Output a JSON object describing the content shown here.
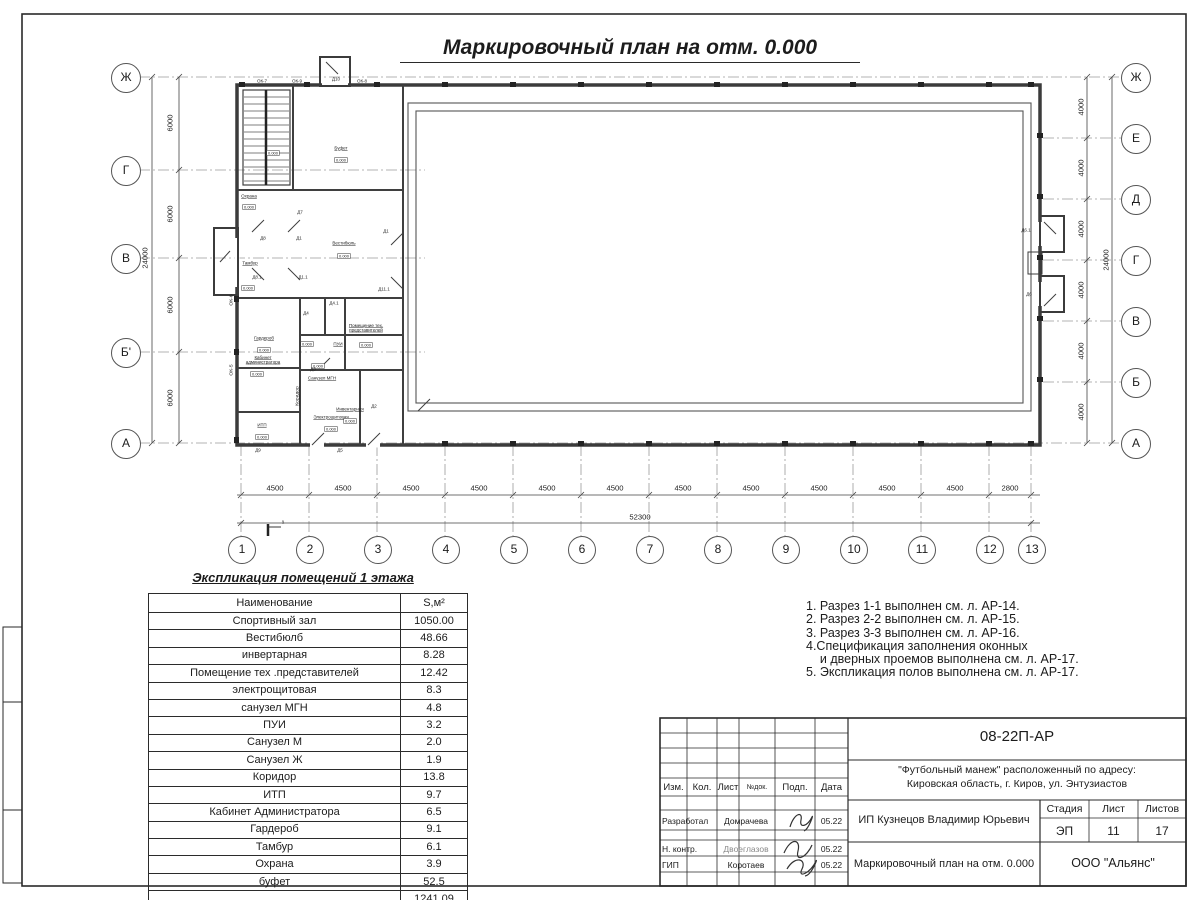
{
  "sheet": {
    "title": "Маркировочный план на отм. 0.000"
  },
  "plan": {
    "axes_left": [
      {
        "label": "Ж",
        "y": 77
      },
      {
        "label": "Г",
        "y": 170
      },
      {
        "label": "В",
        "y": 258
      },
      {
        "label": "Б'",
        "y": 352
      },
      {
        "label": "А",
        "y": 443
      }
    ],
    "axes_right": [
      {
        "label": "Ж",
        "y": 77
      },
      {
        "label": "Е",
        "y": 138
      },
      {
        "label": "Д",
        "y": 199
      },
      {
        "label": "Г",
        "y": 260
      },
      {
        "label": "В",
        "y": 321
      },
      {
        "label": "Б",
        "y": 382
      },
      {
        "label": "А",
        "y": 443
      }
    ],
    "columns": [
      {
        "label": "1",
        "x": 241
      },
      {
        "label": "2",
        "x": 309
      },
      {
        "label": "3",
        "x": 377
      },
      {
        "label": "4",
        "x": 445
      },
      {
        "label": "5",
        "x": 513
      },
      {
        "label": "6",
        "x": 581
      },
      {
        "label": "7",
        "x": 649
      },
      {
        "label": "8",
        "x": 717
      },
      {
        "label": "9",
        "x": 785
      },
      {
        "label": "10",
        "x": 853
      },
      {
        "label": "11",
        "x": 921
      },
      {
        "label": "12",
        "x": 989
      },
      {
        "label": "13",
        "x": 1031
      }
    ],
    "dims_bottom": [
      {
        "v": "4500",
        "x": 275
      },
      {
        "v": "4500",
        "x": 343
      },
      {
        "v": "4500",
        "x": 411
      },
      {
        "v": "4500",
        "x": 479
      },
      {
        "v": "4500",
        "x": 547
      },
      {
        "v": "4500",
        "x": 615
      },
      {
        "v": "4500",
        "x": 683
      },
      {
        "v": "4500",
        "x": 751
      },
      {
        "v": "4500",
        "x": 819
      },
      {
        "v": "4500",
        "x": 887
      },
      {
        "v": "4500",
        "x": 955
      },
      {
        "v": "2800",
        "x": 1010
      }
    ],
    "dims_left": [
      {
        "v": "6000",
        "y": 123
      },
      {
        "v": "6000",
        "y": 214
      },
      {
        "v": "6000",
        "y": 305
      },
      {
        "v": "6000",
        "y": 398
      }
    ],
    "dims_right": [
      {
        "v": "4000",
        "y": 107
      },
      {
        "v": "4000",
        "y": 168
      },
      {
        "v": "4000",
        "y": 229
      },
      {
        "v": "4000",
        "y": 290
      },
      {
        "v": "4000",
        "y": 351
      },
      {
        "v": "4000",
        "y": 412
      }
    ],
    "dim_total_bottom": "52300",
    "dim_total_left": "24000",
    "dim_total_right": "24000",
    "section_label": "1",
    "level_text": "0.000",
    "rooms": [
      {
        "t": "Охрана",
        "x": 249,
        "y": 196
      },
      {
        "t": "Буфет",
        "x": 341,
        "y": 148
      },
      {
        "t": "Вестибюль",
        "x": 344,
        "y": 243
      },
      {
        "t": "Тамбур",
        "x": 250,
        "y": 263
      },
      {
        "t": "Гардероб",
        "x": 264,
        "y": 338
      },
      {
        "t": "Кабинет администратора",
        "x": 263,
        "y": 360,
        "wrap": true
      },
      {
        "t": "ИТП",
        "x": 262,
        "y": 425
      },
      {
        "t": "ПУИ",
        "x": 338,
        "y": 344
      },
      {
        "t": "Санузел МГН",
        "x": 322,
        "y": 378
      },
      {
        "t": "Коридор",
        "x": 297,
        "y": 396,
        "rot": true
      },
      {
        "t": "Электрощитовая",
        "x": 331,
        "y": 417
      },
      {
        "t": "Инвентарная",
        "x": 350,
        "y": 409
      },
      {
        "t": "Помещение тех. представителей",
        "x": 366,
        "y": 328,
        "wrap": true
      }
    ],
    "levels": [
      {
        "x": 273,
        "y": 153
      },
      {
        "x": 341,
        "y": 160
      },
      {
        "x": 344,
        "y": 256
      },
      {
        "x": 248,
        "y": 288
      },
      {
        "x": 264,
        "y": 350
      },
      {
        "x": 257,
        "y": 374
      },
      {
        "x": 262,
        "y": 437
      },
      {
        "x": 307,
        "y": 344
      },
      {
        "x": 318,
        "y": 366
      },
      {
        "x": 331,
        "y": 429
      },
      {
        "x": 350,
        "y": 421
      },
      {
        "x": 366,
        "y": 345
      },
      {
        "x": 249,
        "y": 207
      }
    ],
    "marks": [
      {
        "t": "ОК-7",
        "x": 262,
        "y": 81
      },
      {
        "t": "ОК-9",
        "x": 297,
        "y": 81
      },
      {
        "t": "Д10",
        "x": 336,
        "y": 79
      },
      {
        "t": "ОК-8",
        "x": 362,
        "y": 81
      },
      {
        "t": "Д8",
        "x": 263,
        "y": 238
      },
      {
        "t": "Д1",
        "x": 299,
        "y": 238
      },
      {
        "t": "Д8.1",
        "x": 257,
        "y": 277
      },
      {
        "t": "Д1.1",
        "x": 303,
        "y": 277
      },
      {
        "t": "Д7",
        "x": 300,
        "y": 212
      },
      {
        "t": "Д1",
        "x": 386,
        "y": 231
      },
      {
        "t": "Д11.1",
        "x": 384,
        "y": 289
      },
      {
        "t": "Д4",
        "x": 306,
        "y": 313
      },
      {
        "t": "Д4.1",
        "x": 334,
        "y": 303
      },
      {
        "t": "Д3",
        "x": 313,
        "y": 369
      },
      {
        "t": "Д2",
        "x": 374,
        "y": 406
      },
      {
        "t": "Д6.1",
        "x": 1026,
        "y": 230
      },
      {
        "t": "Д6",
        "x": 1029,
        "y": 294
      },
      {
        "t": "ОК-6",
        "x": 231,
        "y": 300,
        "rot": true
      },
      {
        "t": "ОК-5",
        "x": 231,
        "y": 370,
        "rot": true
      },
      {
        "t": "Д9",
        "x": 258,
        "y": 450
      },
      {
        "t": "Д5",
        "x": 340,
        "y": 450
      }
    ]
  },
  "explication": {
    "title": "Экспликация помещений 1 этажа",
    "col_name": "Наименование",
    "col_area": "S,м²",
    "rows": [
      [
        "Спортивный зал",
        "1050.00"
      ],
      [
        "Вестибюлб",
        "48.66"
      ],
      [
        "инвертарная",
        "8.28"
      ],
      [
        "Помещение тех .представителей",
        "12.42"
      ],
      [
        "электрощитовая",
        "8.3"
      ],
      [
        "санузел МГН",
        "4.8"
      ],
      [
        "ПУИ",
        "3.2"
      ],
      [
        "Санузел М",
        "2.0"
      ],
      [
        "Санузел Ж",
        "1.9"
      ],
      [
        "Коридор",
        "13.8"
      ],
      [
        "ИТП",
        "9.7"
      ],
      [
        "Кабинет Администратора",
        "6.5"
      ],
      [
        "Гардероб",
        "9.1"
      ],
      [
        "Тамбур",
        "6.1"
      ],
      [
        "Охрана",
        "3.9"
      ],
      [
        "буфет",
        "52.5"
      ],
      [
        "",
        "1241.09"
      ]
    ]
  },
  "notes": [
    "1. Разрез 1-1 выполнен см. л. АР-14.",
    "2. Разрез 2-2 выполнен см. л. АР-15.",
    "3. Разрез 3-3 выполнен см. л. АР-16.",
    "4.Спецификация заполнения оконных",
    "    и дверных проемов выполнена см. л. АР-17.",
    "5. Экспликация полов выполнена см. л. АР-17."
  ],
  "titleblock": {
    "doc_number": "08-22П-АР",
    "project_line1": "\"Футбольный манеж\" расположенный по адресу:",
    "project_line2": "Кировская область, г. Киров, ул. Энтузиастов",
    "client": "ИП Кузнецов Владимир Юрьевич",
    "drawing_name": "Маркировочный план на отм. 0.000",
    "company": "ООО \"Альянс\"",
    "stage_label": "Стадия",
    "sheet_label": "Лист",
    "sheets_label": "Листов",
    "stage": "ЭП",
    "sheet": "11",
    "sheets": "17",
    "hdr_izm": "Изм.",
    "hdr_kol": "Кол.",
    "hdr_list": "Лист",
    "hdr_dok": "№док.",
    "hdr_podp": "Подп.",
    "hdr_data": "Дата",
    "rows": [
      {
        "role": "Разработал",
        "name": "Домрачева",
        "date": "05.22"
      },
      {
        "role": "Н. контр.",
        "name": "Двоеглазов",
        "date": "05.22"
      },
      {
        "role": "ГИП",
        "name": "Коротаев",
        "date": "05.22"
      }
    ]
  }
}
